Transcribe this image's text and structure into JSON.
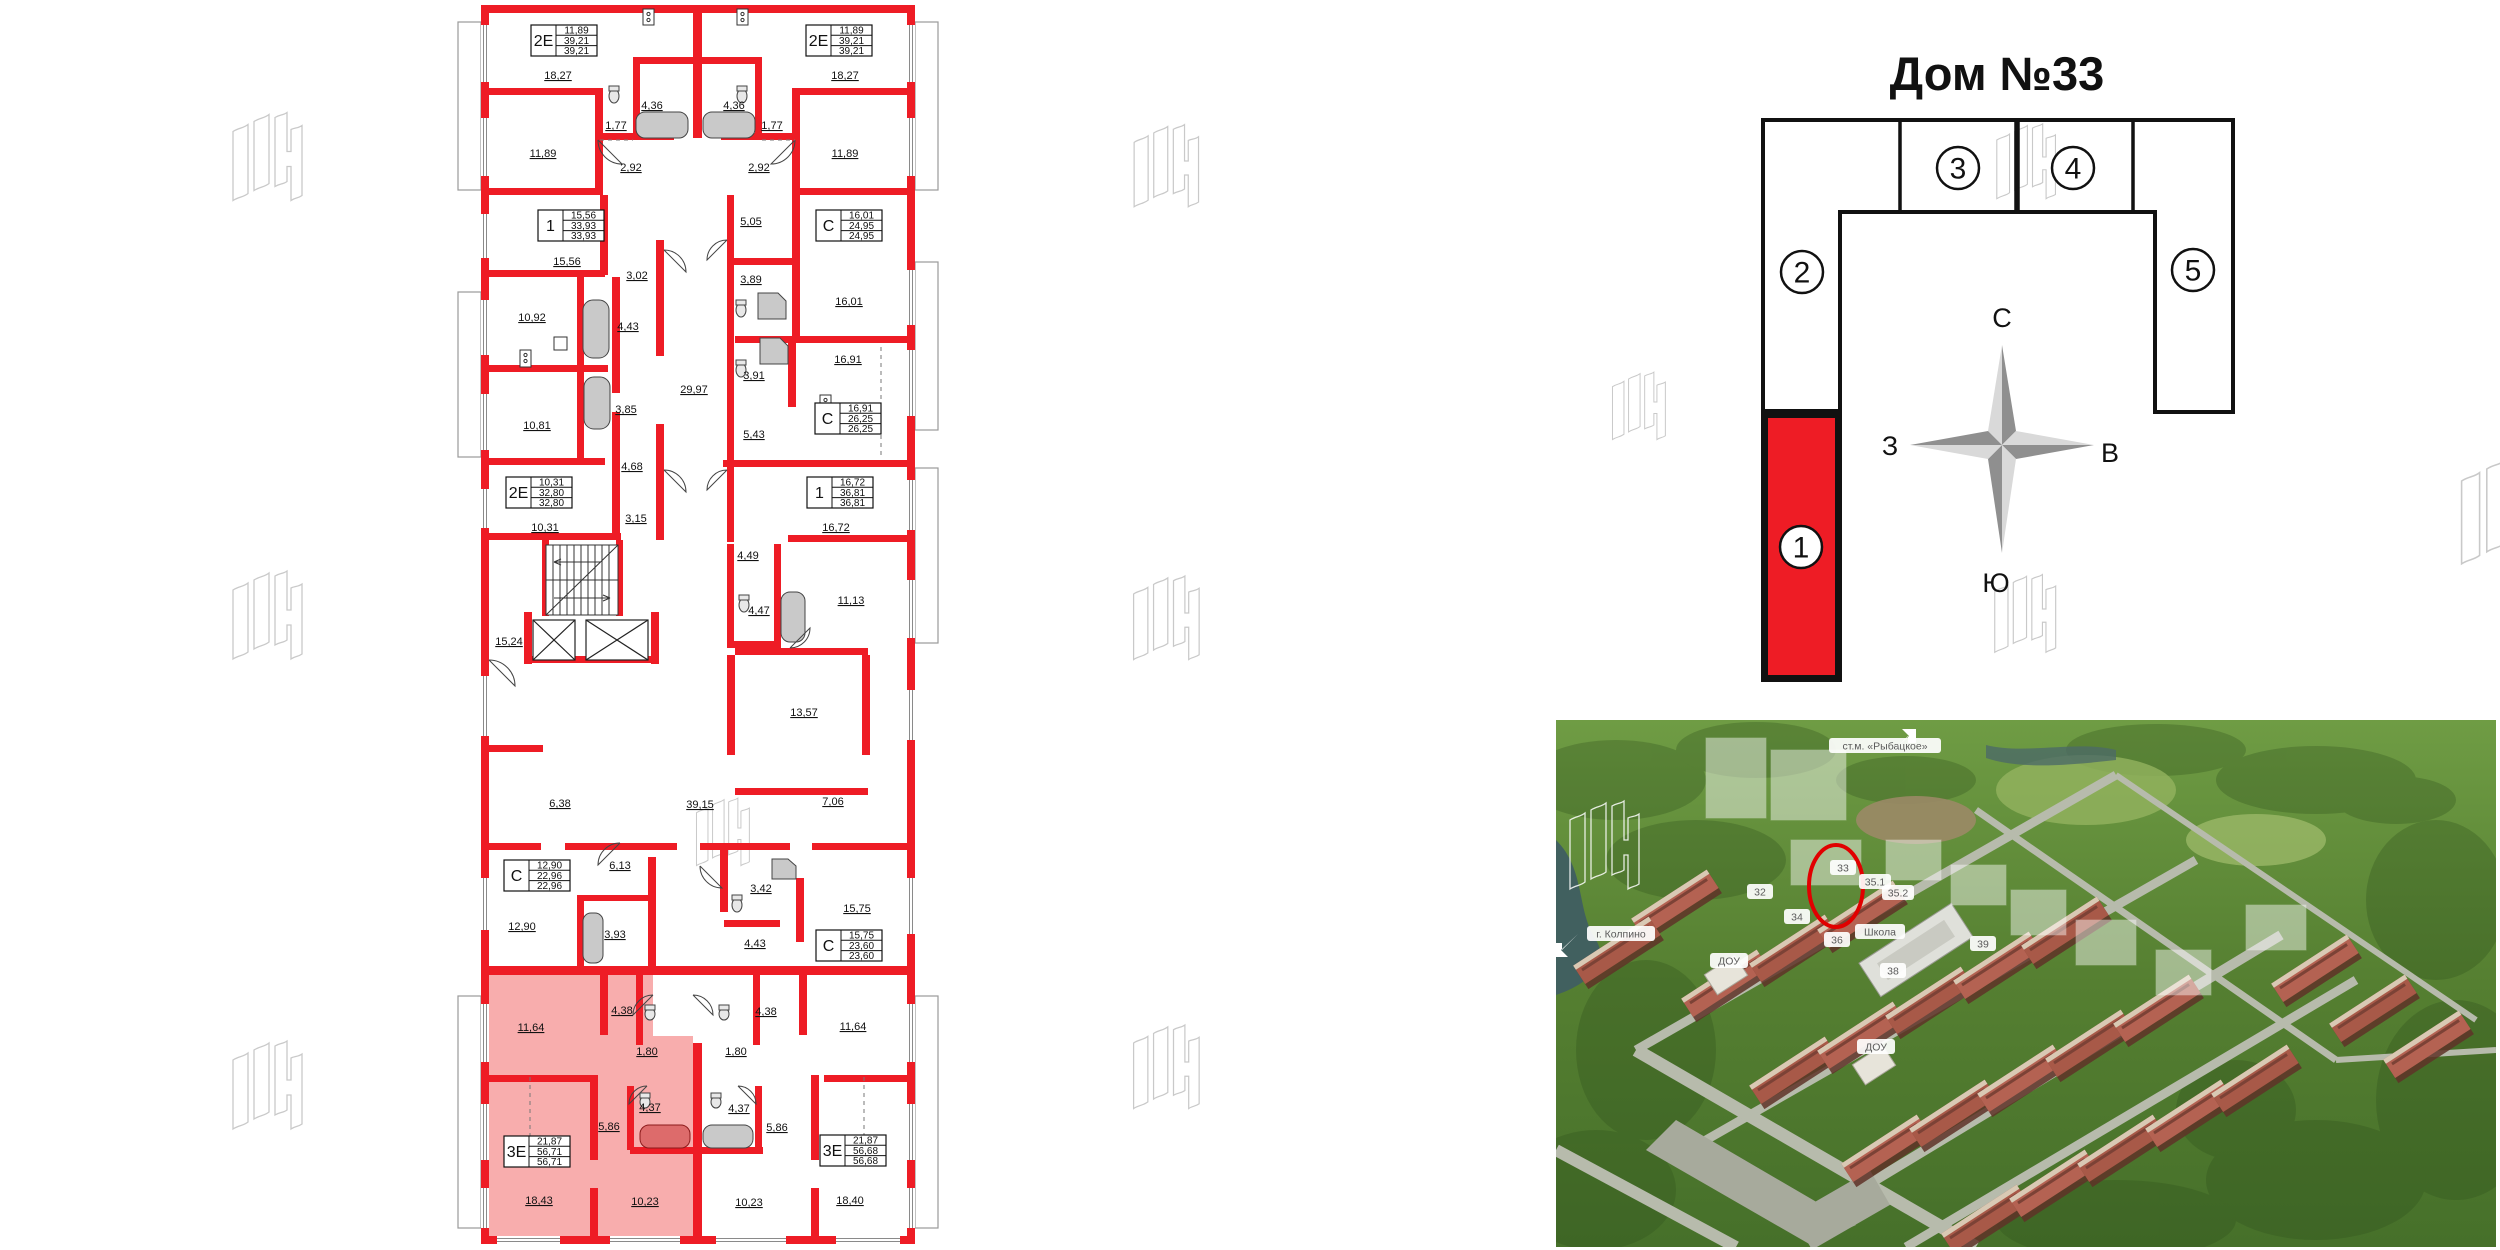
{
  "colors": {
    "wall_red": "#ee1c25",
    "highlight_pink": "rgba(242,105,105,0.55)",
    "scheme_red": "#ee1c25",
    "circle_red": "#e10000",
    "watermark_gray": "#c9c9c9"
  },
  "floor_plan": {
    "stamps": [
      {
        "type": "2Е",
        "values": [
          "11,89",
          "39,21",
          "39,21"
        ],
        "x": 531,
        "y": 25
      },
      {
        "type": "2Е",
        "values": [
          "11,89",
          "39,21",
          "39,21"
        ],
        "x": 806,
        "y": 25
      },
      {
        "type": "1",
        "values": [
          "15,56",
          "33,93",
          "33,93"
        ],
        "x": 538,
        "y": 210
      },
      {
        "type": "С",
        "values": [
          "16,01",
          "24,95",
          "24,95"
        ],
        "x": 816,
        "y": 210
      },
      {
        "type": "С",
        "values": [
          "16,91",
          "26,25",
          "26,25"
        ],
        "x": 815,
        "y": 403
      },
      {
        "type": "2Е",
        "values": [
          "10,31",
          "32,80",
          "32,80"
        ],
        "x": 506,
        "y": 477
      },
      {
        "type": "1",
        "values": [
          "16,72",
          "36,81",
          "36,81"
        ],
        "x": 807,
        "y": 477
      },
      {
        "type": "С",
        "values": [
          "12,90",
          "22,96",
          "22,96"
        ],
        "x": 504,
        "y": 860
      },
      {
        "type": "С",
        "values": [
          "15,75",
          "23,60",
          "23,60"
        ],
        "x": 816,
        "y": 930
      },
      {
        "type": "3Е",
        "values": [
          "21,87",
          "56,71",
          "56,71"
        ],
        "x": 504,
        "y": 1136,
        "highlighted": true
      },
      {
        "type": "3Е",
        "values": [
          "21,87",
          "56,68",
          "56,68"
        ],
        "x": 820,
        "y": 1135
      }
    ],
    "rooms": [
      {
        "t": "18,27",
        "x": 558,
        "y": 75
      },
      {
        "t": "18,27",
        "x": 845,
        "y": 75
      },
      {
        "t": "4,36",
        "x": 652,
        "y": 105
      },
      {
        "t": "4,36",
        "x": 734,
        "y": 105
      },
      {
        "t": "1,77",
        "x": 616,
        "y": 125
      },
      {
        "t": "1,77",
        "x": 772,
        "y": 125
      },
      {
        "t": "11,89",
        "x": 543,
        "y": 153
      },
      {
        "t": "11,89",
        "x": 845,
        "y": 153
      },
      {
        "t": "2,92",
        "x": 631,
        "y": 167
      },
      {
        "t": "2,92",
        "x": 759,
        "y": 167
      },
      {
        "t": "15,56",
        "x": 567,
        "y": 261
      },
      {
        "t": "5,05",
        "x": 751,
        "y": 221
      },
      {
        "t": "3,02",
        "x": 637,
        "y": 275
      },
      {
        "t": "3,89",
        "x": 751,
        "y": 279
      },
      {
        "t": "16,01",
        "x": 849,
        "y": 301
      },
      {
        "t": "10,92",
        "x": 532,
        "y": 317
      },
      {
        "t": "4,43",
        "x": 628,
        "y": 326
      },
      {
        "t": "16,91",
        "x": 848,
        "y": 359
      },
      {
        "t": "3,91",
        "x": 754,
        "y": 375
      },
      {
        "t": "29,97",
        "x": 694,
        "y": 389
      },
      {
        "t": "3,85",
        "x": 626,
        "y": 409
      },
      {
        "t": "10,81",
        "x": 537,
        "y": 425
      },
      {
        "t": "5,43",
        "x": 754,
        "y": 434
      },
      {
        "t": "4,68",
        "x": 632,
        "y": 466
      },
      {
        "t": "3,15",
        "x": 636,
        "y": 518
      },
      {
        "t": "10,31",
        "x": 545,
        "y": 527
      },
      {
        "t": "16,72",
        "x": 836,
        "y": 527
      },
      {
        "t": "4,49",
        "x": 748,
        "y": 555
      },
      {
        "t": "4,47",
        "x": 759,
        "y": 610
      },
      {
        "t": "11,13",
        "x": 851,
        "y": 600
      },
      {
        "t": "15,24",
        "x": 509,
        "y": 641
      },
      {
        "t": "13,57",
        "x": 804,
        "y": 712
      },
      {
        "t": "6,38",
        "x": 560,
        "y": 803
      },
      {
        "t": "39,15",
        "x": 700,
        "y": 804
      },
      {
        "t": "7,06",
        "x": 833,
        "y": 801
      },
      {
        "t": "6,13",
        "x": 620,
        "y": 865
      },
      {
        "t": "3,42",
        "x": 761,
        "y": 888
      },
      {
        "t": "15,75",
        "x": 857,
        "y": 908
      },
      {
        "t": "12,90",
        "x": 522,
        "y": 926
      },
      {
        "t": "3,93",
        "x": 615,
        "y": 934
      },
      {
        "t": "4,43",
        "x": 755,
        "y": 943
      },
      {
        "t": "4,38",
        "x": 622,
        "y": 1010
      },
      {
        "t": "4,38",
        "x": 766,
        "y": 1011
      },
      {
        "t": "11,64",
        "x": 531,
        "y": 1027
      },
      {
        "t": "11,64",
        "x": 853,
        "y": 1026
      },
      {
        "t": "1,80",
        "x": 647,
        "y": 1051
      },
      {
        "t": "1,80",
        "x": 736,
        "y": 1051
      },
      {
        "t": "4,37",
        "x": 650,
        "y": 1107
      },
      {
        "t": "4,37",
        "x": 739,
        "y": 1108
      },
      {
        "t": "5,86",
        "x": 609,
        "y": 1126
      },
      {
        "t": "5,86",
        "x": 777,
        "y": 1127
      },
      {
        "t": "18,43",
        "x": 539,
        "y": 1200
      },
      {
        "t": "10,23",
        "x": 645,
        "y": 1201
      },
      {
        "t": "10,23",
        "x": 749,
        "y": 1202
      },
      {
        "t": "18,40",
        "x": 850,
        "y": 1200
      }
    ]
  },
  "scheme": {
    "title": "Дом №33",
    "compass": {
      "n": "С",
      "s": "Ю",
      "w": "З",
      "e": "В"
    },
    "sections": [
      {
        "label": "1",
        "cx": 1801,
        "cy": 547,
        "highlighted": true
      },
      {
        "label": "2",
        "cx": 1802,
        "cy": 272,
        "highlighted": false
      },
      {
        "label": "3",
        "cx": 1958,
        "cy": 168,
        "highlighted": false
      },
      {
        "label": "4",
        "cx": 2073,
        "cy": 168,
        "highlighted": false
      },
      {
        "label": "5",
        "cx": 2193,
        "cy": 270,
        "highlighted": false
      }
    ]
  },
  "aerial": {
    "landmarks": [
      {
        "text": "ст.м. «Рыбацкое»",
        "x": 273,
        "y": 18,
        "w": 112,
        "arrow": "ne"
      },
      {
        "text": "г. Колпино",
        "x": 31,
        "y": 206,
        "w": 68,
        "arrow": "sw"
      }
    ],
    "buildings": [
      {
        "text": "32",
        "x": 191,
        "y": 164,
        "w": 26
      },
      {
        "text": "33",
        "x": 274,
        "y": 140,
        "w": 26
      },
      {
        "text": "35.1",
        "x": 303,
        "y": 154,
        "w": 32
      },
      {
        "text": "35.2",
        "x": 326,
        "y": 165,
        "w": 32
      },
      {
        "text": "34",
        "x": 228,
        "y": 189,
        "w": 26
      },
      {
        "text": "Школа",
        "x": 299,
        "y": 204,
        "w": 50
      },
      {
        "text": "36",
        "x": 268,
        "y": 212,
        "w": 26
      },
      {
        "text": "38",
        "x": 324,
        "y": 243,
        "w": 26
      },
      {
        "text": "39",
        "x": 414,
        "y": 216,
        "w": 26
      },
      {
        "text": "ДОУ",
        "x": 154,
        "y": 233,
        "w": 38
      },
      {
        "text": "ДОУ",
        "x": 301,
        "y": 319,
        "w": 38
      }
    ]
  }
}
